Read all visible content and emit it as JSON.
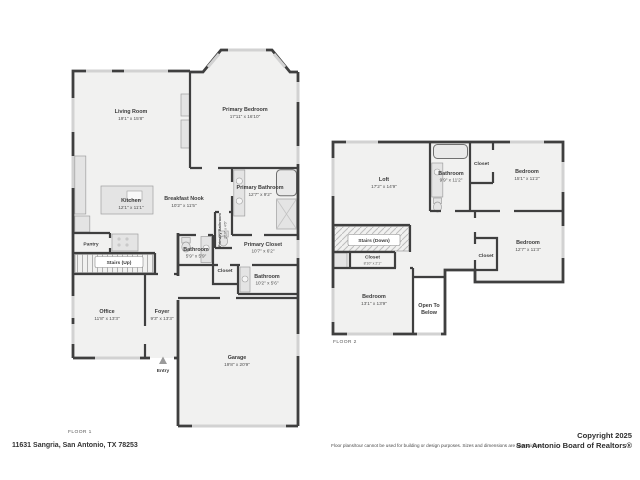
{
  "page": {
    "address": "11631 Sangria, San Antonio, TX 78253",
    "disclaimer": "Floor plans/tour cannot be used for building or design purposes. Sizes and dimensions are approximate.",
    "copyright_line1": "Copyright 2025",
    "copyright_line2": "San Antonio Board of Realtors®"
  },
  "colors": {
    "wall": "#3f3f3f",
    "room_fill": "#f1f1f0",
    "window": "#d2d2d2",
    "text": "#3b3b3b"
  },
  "floor1": {
    "label": "FLOOR 1",
    "rooms": {
      "living": {
        "name": "Living Room",
        "dims": "19'1\" x 15'8\""
      },
      "primary_bedroom": {
        "name": "Primary Bedroom",
        "dims": "17'11\" x 16'10\""
      },
      "kitchen": {
        "name": "Kitchen",
        "dims": "12'1\" x 11'1\""
      },
      "breakfast_nook": {
        "name": "Breakfast Nook",
        "dims": "10'2\" x 11'5\""
      },
      "primary_bathroom": {
        "name": "Primary Bathroom",
        "dims": "12'7\" x 9'2\""
      },
      "primary_wc": {
        "name": "Primary Bathroom",
        "dims": "2'10\" x 4'6\""
      },
      "primary_closet": {
        "name": "Primary Closet",
        "dims": "10'7\" x 6'2\""
      },
      "pantry": {
        "name": "Pantry"
      },
      "stairs": {
        "name": "Stairs (Up)"
      },
      "bathroom_small": {
        "name": "Bathroom",
        "dims": "5'9\" x 5'9\""
      },
      "closet": {
        "name": "Closet"
      },
      "bathroom2": {
        "name": "Bathroom",
        "dims": "10'2\" x 5'6\""
      },
      "office": {
        "name": "Office",
        "dims": "11'8\" x 13'3\""
      },
      "foyer": {
        "name": "Foyer",
        "dims": "9'3\" x 13'3\""
      },
      "entry": {
        "name": "Entry"
      },
      "garage": {
        "name": "Garage",
        "dims": "19'8\" x 20'9\""
      }
    }
  },
  "floor2": {
    "label": "FLOOR 2",
    "rooms": {
      "loft": {
        "name": "Loft",
        "dims": "17'2\" x 14'9\""
      },
      "bathroom": {
        "name": "Bathroom",
        "dims": "9'9\" x 11'2\""
      },
      "closet_top": {
        "name": "Closet"
      },
      "bedroom_tr": {
        "name": "Bedroom",
        "dims": "15'1\" x 11'2\""
      },
      "stairs": {
        "name": "Stairs (Down)"
      },
      "closet_stairs": {
        "name": "Closet",
        "dims": "8'10\" x 2'1\""
      },
      "bedroom_bl": {
        "name": "Bedroom",
        "dims": "13'1\" x 13'9\""
      },
      "open_below": {
        "line1": "Open To",
        "line2": "Below"
      },
      "closet_mid": {
        "name": "Closet"
      },
      "bedroom_r": {
        "name": "Bedroom",
        "dims": "12'7\" x 11'3\""
      }
    }
  }
}
